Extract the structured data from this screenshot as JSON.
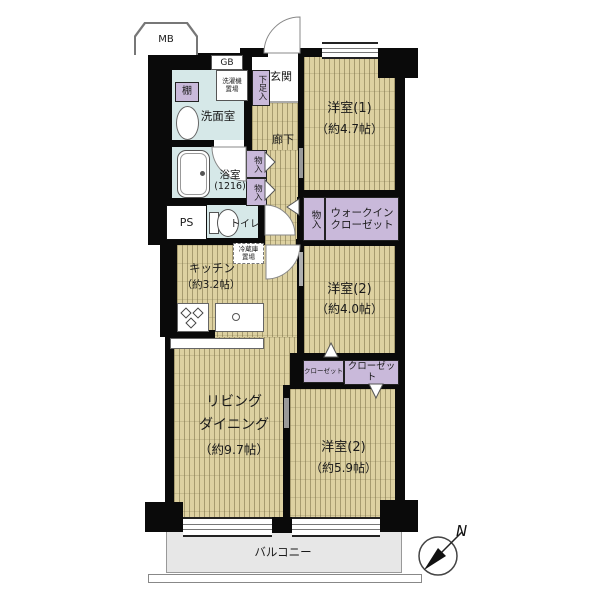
{
  "rooms": {
    "western1": {
      "name": "洋室(1)",
      "size": "（約4.7帖）"
    },
    "western2_mid": {
      "name": "洋室(2)",
      "size": "（約4.0帖）"
    },
    "western2_btm": {
      "name": "洋室(2)",
      "size": "（約5.9帖）"
    },
    "living": {
      "line1": "リビング",
      "line2": "ダイニング",
      "size": "（約9.7帖）"
    },
    "kitchen": {
      "name": "キッチン",
      "size": "（約3.2帖）"
    },
    "washroom": {
      "name": "洗面室"
    },
    "bath": {
      "name": "浴室",
      "size": "(1216)"
    },
    "toilet": {
      "name": "トイレ"
    },
    "entrance": {
      "name": "玄関"
    },
    "corridor": {
      "name": "廊下"
    },
    "balcony": {
      "name": "バルコニー"
    }
  },
  "storage": {
    "shoe_box": "下足入",
    "shelf": "棚",
    "storage_small": "物入",
    "wic_line1": "ウォークイン",
    "wic_line2": "クローゼット",
    "closet": "クローゼット",
    "laundry_line1": "洗濯機",
    "laundry_line2": "置場",
    "fridge_line1": "冷蔵庫",
    "fridge_line2": "置場"
  },
  "utility": {
    "mb": "MB",
    "gb": "GB",
    "ps": "PS"
  },
  "compass": {
    "north": "N"
  },
  "colors": {
    "wood": "#ddd1a1",
    "wood_stripe": "#a79b6e",
    "wet_area": "#d6e8e8",
    "closet_fill": "#c9b9da",
    "balcony_fill": "#e7e7e7",
    "wall": "#0a0a0a"
  }
}
